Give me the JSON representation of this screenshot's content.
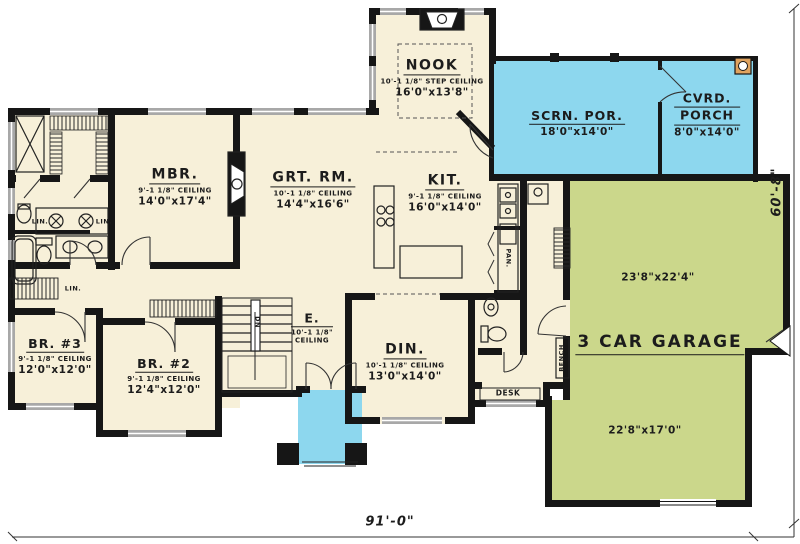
{
  "colors": {
    "cream": "#f7f0d9",
    "porch_blue": "#8dd7ee",
    "garage_green": "#cbd78b",
    "wall": "#161616"
  },
  "overall_dimensions": {
    "width": "91'-0\"",
    "height": "60'-8\""
  },
  "rooms": {
    "mbr": {
      "name": "MBR.",
      "ceiling": "9'-1 1/8\" CEILING",
      "size": "14'0\"x17'4\""
    },
    "grt": {
      "name": "GRT. RM.",
      "ceiling": "10'-1 1/8\" CEILING",
      "size": "14'4\"x16'6\""
    },
    "nook": {
      "name": "NOOK",
      "ceiling": "10'-1 1/8\" STEP CEILING",
      "size": "16'0\"x13'8\""
    },
    "kit": {
      "name": "KIT.",
      "ceiling": "9'-1 1/8\" CEILING",
      "size": "16'0\"x14'0\""
    },
    "scrn": {
      "name": "SCRN. POR.",
      "size": "18'0\"x14'0\""
    },
    "cvrd": {
      "name_line1": "CVRD.",
      "name_line2": "PORCH",
      "size": "8'0\"x14'0\""
    },
    "garage": {
      "name": "3 CAR GARAGE",
      "size_upper": "23'8\"x22'4\"",
      "size_lower": "22'8\"x17'0\""
    },
    "br3": {
      "name": "BR. #3",
      "ceiling": "9'-1 1/8\" CEILING",
      "size": "12'0\"x12'0\""
    },
    "br2": {
      "name": "BR. #2",
      "ceiling": "9'-1 1/8\" CEILING",
      "size": "12'4\"x12'0\""
    },
    "din": {
      "name": "DIN.",
      "ceiling": "10'-1 1/8\" CEILING",
      "size": "13'0\"x14'0\""
    },
    "entry": {
      "name": "E.",
      "ceiling_line1": "10'-1 1/8\"",
      "ceiling_line2": "CEILING"
    }
  },
  "annotations": {
    "pantry": "PAN.",
    "linen": "LIN.",
    "desk": "DESK",
    "bench": "BENCH",
    "stairs_down": "DN"
  }
}
